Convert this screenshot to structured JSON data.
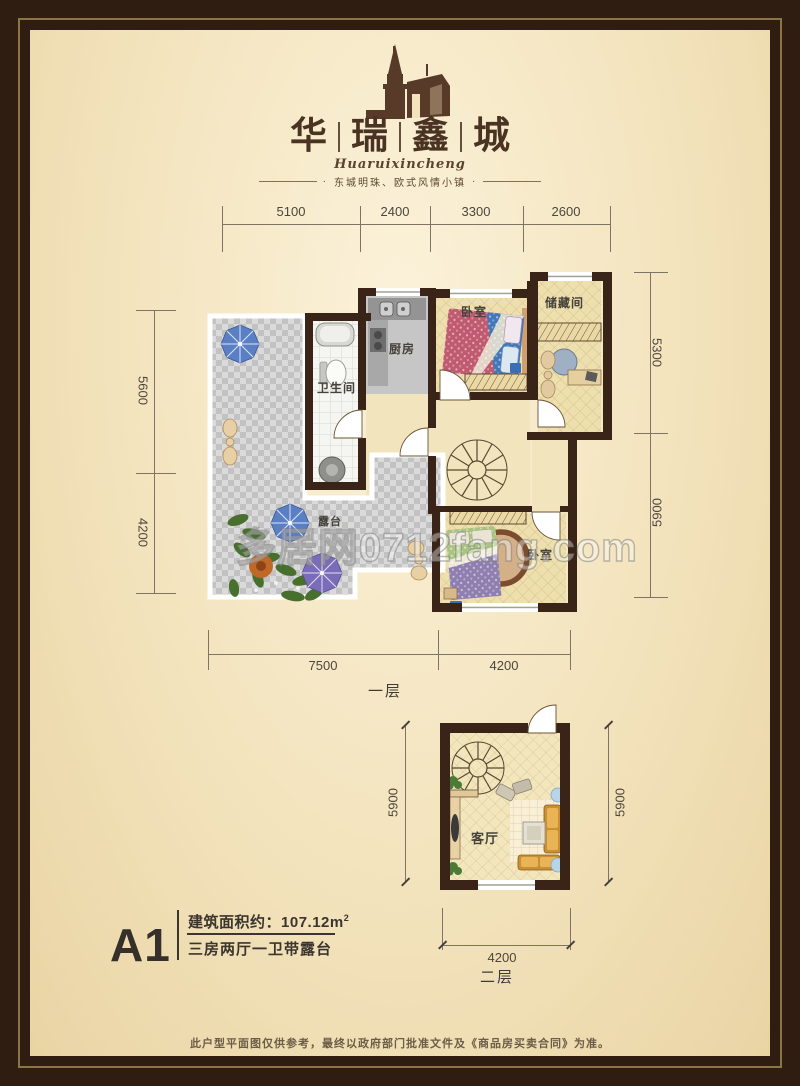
{
  "brand": {
    "chars": [
      "华",
      "瑞",
      "鑫",
      "城"
    ],
    "script": "Huaruixincheng",
    "tagline": "东城明珠、欧式风情小镇",
    "dot": "·"
  },
  "floor1": {
    "label": "一层",
    "dims_top": [
      "5100",
      "2400",
      "3300",
      "2600"
    ],
    "dims_left": [
      "5600",
      "4200"
    ],
    "dims_right": [
      "5300",
      "5900"
    ],
    "dims_bottom": [
      "7500",
      "4200"
    ],
    "rooms": {
      "bathroom": "卫生间",
      "kitchen": "厨房",
      "bedroom_top": "卧室",
      "storage": "储藏间",
      "terrace": "露台",
      "bedroom_bottom": "卧室"
    }
  },
  "floor2": {
    "label": "二层",
    "dim_left": "5900",
    "dim_right": "5900",
    "dim_bottom": "4200",
    "room": "客厅"
  },
  "unit": {
    "code": "A1",
    "area_prefix": "建筑面积约：",
    "area_value": "107.12m",
    "area_sup": "2",
    "layout": "三房两厅一卫带露台"
  },
  "watermark": "多居网0712fang.com",
  "footer": {
    "disclaimer": "此户型平面图仅供参考，最终以政府部门批准文件及《商品房买卖合同》为准。"
  },
  "colors": {
    "frame": "#2f1d12",
    "wall": "#3a2417",
    "accent_blue": "#5b7fc4",
    "accent_purple": "#7a6cb8",
    "floor_tan": "#eedfae"
  }
}
